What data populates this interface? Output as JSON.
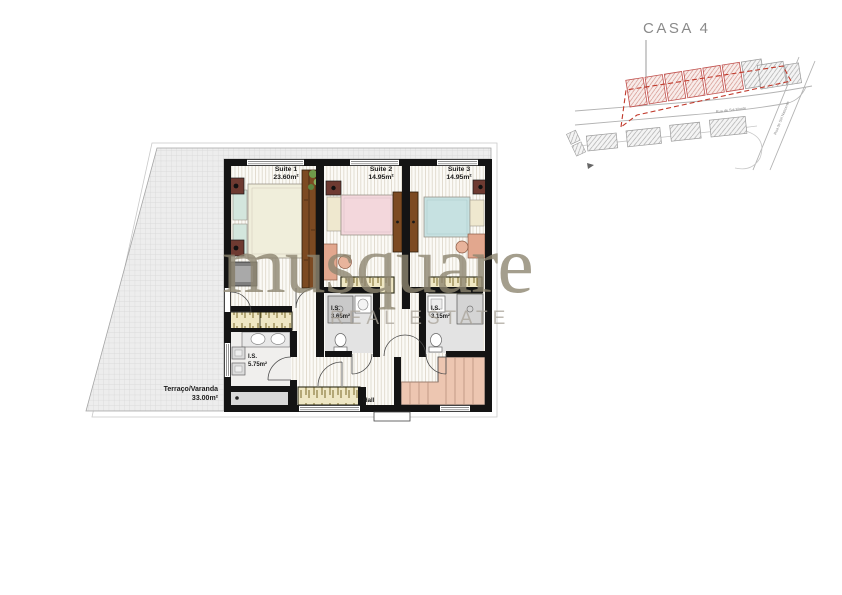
{
  "site_plan": {
    "title": "CASA 4",
    "road_labels": {
      "horizontal": "Rua de Sol Monte",
      "diagonal": "Rua de Sol Nascente"
    }
  },
  "watermark": {
    "brand": "musquare",
    "tagline": "REAL ESTATE"
  },
  "rooms": {
    "suite1": {
      "name": "Suite 1",
      "area": "23.60m²"
    },
    "suite2": {
      "name": "Suite 2",
      "area": "14.95m²"
    },
    "suite3": {
      "name": "Suite 3",
      "area": "14.95m²"
    },
    "is1": {
      "name": "I.S.",
      "area": "5.75m²"
    },
    "is2": {
      "name": "I.S.",
      "area": "3.65m²"
    },
    "is3": {
      "name": "I.S.",
      "area": "3.15m²"
    },
    "hall": {
      "name": "Hall"
    },
    "terrace": {
      "name": "Terraço/Varanda",
      "area": "33.00m²"
    }
  },
  "colors": {
    "walls": "#141414",
    "plot_outline_red": "#c0392b",
    "watermark_tan": "#8e8671",
    "bed_suite1": "#f0eedb",
    "bed_suite2": "#f3d7dc",
    "bed_suite3": "#c6e1e1",
    "stairs_salmon": "#edc6b1",
    "planter_beige": "#efe7c4",
    "wardrobe_brown": "#7c4a22"
  }
}
